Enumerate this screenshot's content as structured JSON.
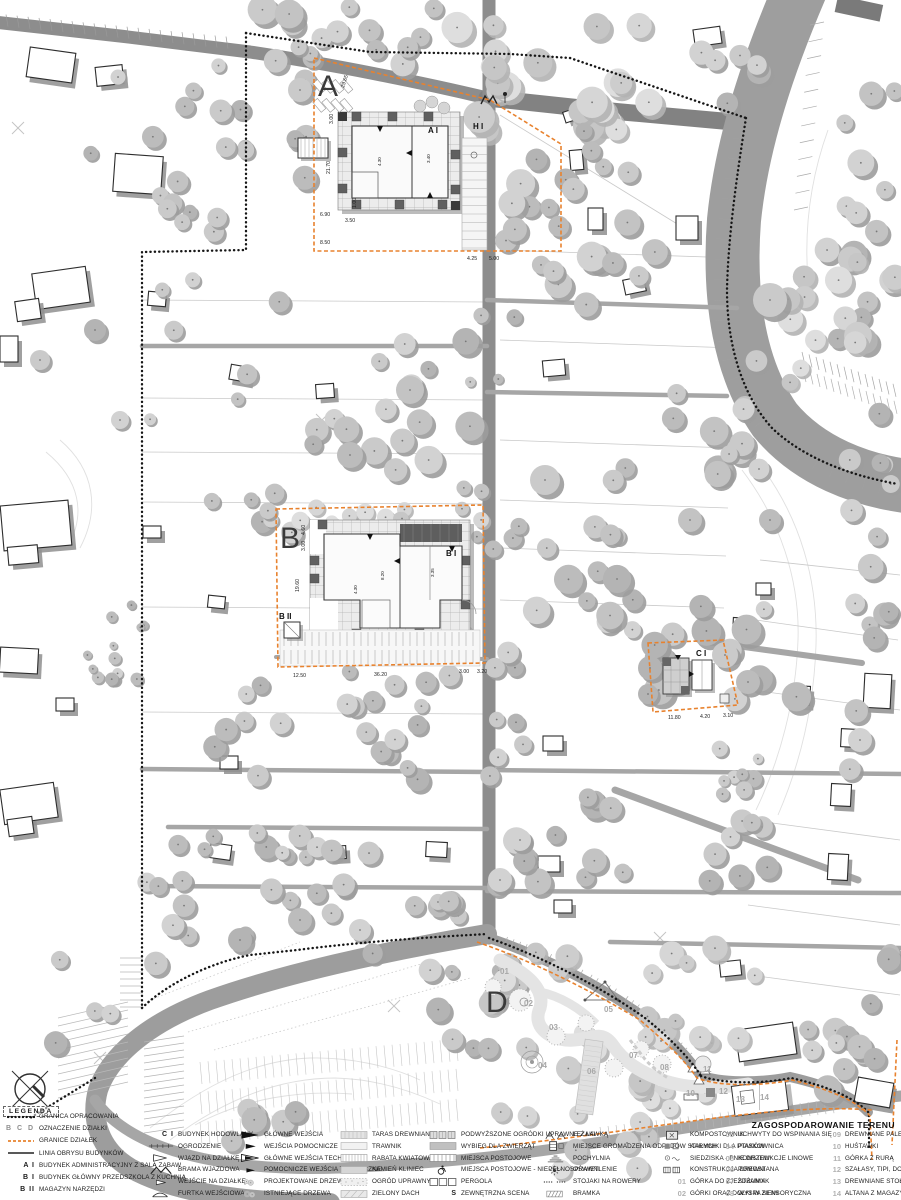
{
  "title": "ZAGOSPODAROWANIE TERENU",
  "legend": {
    "header": "LEGENDA",
    "columns": [
      [
        {
          "icon": "line-dotted",
          "key": "",
          "label": "GRANICA OPRACOWANIA"
        },
        {
          "icon": "letters",
          "key": "A B C D",
          "label": "OZNACZENIE DZIAŁKI"
        },
        {
          "icon": "line-dash-orange",
          "key": "",
          "label": "GRANICE DZIAŁEK"
        },
        {
          "icon": "line-solid",
          "key": "",
          "label": "LINIA OBRYSU BUDYNKÓW"
        },
        {
          "icon": "key",
          "key": "A I",
          "label": "BUDYNEK ADMINISTRACYJNY Z SALĄ ZABAW"
        },
        {
          "icon": "key",
          "key": "B I",
          "label": "BUDYNEK GŁÓWNY PRZEDSZKOLA Z KUCHNIĄ"
        },
        {
          "icon": "key",
          "key": "B II",
          "label": "MAGAZYN NARZĘDZI"
        }
      ],
      [
        {
          "icon": "key",
          "key": "C I",
          "label": "BUDYNEK HODOWLANY"
        },
        {
          "icon": "fence",
          "key": "",
          "label": "OGRODZENIE"
        },
        {
          "icon": "tri-open-lg",
          "key": "",
          "label": "WJAZD NA DZIAŁKĘ"
        },
        {
          "icon": "gate-m",
          "key": "",
          "label": "BRAMA WJAZDOWA"
        },
        {
          "icon": "tri-open-sm",
          "key": "",
          "label": "WEJŚCIE NA DZIAŁKĘ"
        },
        {
          "icon": "gate-f",
          "key": "",
          "label": "FURTKA WEJŚCIOWA"
        }
      ],
      [
        {
          "icon": "arr-lg",
          "key": "",
          "label": "GŁÓWNE WEJŚCIA"
        },
        {
          "icon": "arr-sm",
          "key": "",
          "label": "WEJŚCIA POMOCNICZE"
        },
        {
          "icon": "arr-open",
          "key": "",
          "label": "GŁÓWNE WEJŚCIA TECHNICZNE"
        },
        {
          "icon": "arr-sm2",
          "key": "",
          "label": "POMOCNICZE WEJŚCIA TECHNICZNE"
        },
        {
          "icon": "trees-new",
          "key": "",
          "label": "PROJEKTOWANE DRZEWA"
        },
        {
          "icon": "trees-old",
          "key": "",
          "label": "ISTNIEJĄCE DRZEWA"
        }
      ],
      [
        {
          "icon": "sw-taras",
          "key": "",
          "label": "TARAS DREWNIANY"
        },
        {
          "icon": "sw-trawnik",
          "key": "",
          "label": "TRAWNIK"
        },
        {
          "icon": "sw-rabata",
          "key": "",
          "label": "RABATA KWIATOWA"
        },
        {
          "icon": "sw-kamien",
          "key": "",
          "label": "KAMIEŃ KLINIEC"
        },
        {
          "icon": "sw-ogrod",
          "key": "",
          "label": "OGRÓD UPRAWNY"
        },
        {
          "icon": "sw-dach",
          "key": "",
          "label": "ZIELONY DACH"
        }
      ],
      [
        {
          "icon": "boxes3",
          "key": "",
          "label": "PODWYŻSZONE OGRÓDKI UPRAWNE Z ŁAWKĄ"
        },
        {
          "icon": "sw-wybieg",
          "key": "",
          "label": "WYBIEG DLA ZWIERZĄT"
        },
        {
          "icon": "sw-postoj",
          "key": "",
          "label": "MIEJSCA POSTOJOWE"
        },
        {
          "icon": "disabled",
          "key": "",
          "label": "MIEJSCA POSTOJOWE - NIEPEŁNOSPRAWNI"
        },
        {
          "icon": "pergola",
          "key": "",
          "label": "PERGOLA"
        },
        {
          "icon": "key",
          "key": "S",
          "label": "ZEWNĘTRZNA SCENA"
        }
      ],
      [
        {
          "icon": "lezaki",
          "key": "",
          "label": "LEŻAKI"
        },
        {
          "icon": "odpady",
          "key": "",
          "label": "MIEJSCE GROMADZENIA ODPADÓW STAŁYCH"
        },
        {
          "icon": "ramp",
          "key": "",
          "label": "POCHYLNIA"
        },
        {
          "icon": "light",
          "key": "",
          "label": "OŚWIETLENIE"
        },
        {
          "icon": "bikes",
          "key": "",
          "label": "STOJAKI NA ROWERY"
        },
        {
          "icon": "bramka",
          "key": "",
          "label": "BRAMKA"
        }
      ],
      [
        {
          "icon": "kompost",
          "key": "",
          "label": "KOMPOSTOWNIK"
        },
        {
          "icon": "karmnik",
          "key": "",
          "label": "KARMNIKI DLA PTAKÓW"
        },
        {
          "icon": "siedziska",
          "key": "",
          "label": "SIEDZISKA - PNIE DRZEW"
        },
        {
          "icon": "konstrukcja",
          "key": "",
          "label": "KONSTRUKCJA DREWNIANA"
        },
        {
          "icon": "num",
          "key": "01",
          "label": "GÓRKA DO ZJEŻDŻANIA"
        },
        {
          "icon": "num",
          "key": "02",
          "label": "GÓRKI ORAZ DOŁKI W ZIEMI"
        }
      ],
      [
        {
          "icon": "num",
          "key": "03",
          "label": "UCHWYTY DO WSPINANIA SIĘ"
        },
        {
          "icon": "num",
          "key": "04",
          "label": "PIASKOWNICA"
        },
        {
          "icon": "num",
          "key": "05",
          "label": "KONSTRUKCJE LINOWE"
        },
        {
          "icon": "num",
          "key": "06",
          "label": "POMOST"
        },
        {
          "icon": "num",
          "key": "07",
          "label": "STRUMYK"
        },
        {
          "icon": "num",
          "key": "08",
          "label": "WYSPA SENSORYCZNA"
        }
      ],
      [
        {
          "icon": "num",
          "key": "09",
          "label": "DREWNIANE PALE"
        },
        {
          "icon": "num",
          "key": "10",
          "label": "HUŚTAWKI"
        },
        {
          "icon": "num",
          "key": "11",
          "label": "GÓRKA Z RURĄ"
        },
        {
          "icon": "num",
          "key": "12",
          "label": "SZAŁASY, TIPI, DOMKI"
        },
        {
          "icon": "num",
          "key": "13",
          "label": "DREWNIANE STOŁECZKI"
        },
        {
          "icon": "num",
          "key": "14",
          "label": "ALTANA Z MAGAZYNEM"
        }
      ]
    ]
  },
  "map": {
    "plot_letters": [
      {
        "t": "A",
        "x": 318,
        "y": 96
      },
      {
        "t": "B",
        "x": 280,
        "y": 548
      },
      {
        "t": "D",
        "x": 486,
        "y": 1012
      }
    ],
    "building_labels": [
      {
        "t": "A I",
        "x": 428,
        "y": 133
      },
      {
        "t": "B I",
        "x": 446,
        "y": 556
      },
      {
        "t": "B II",
        "x": 279,
        "y": 619
      },
      {
        "t": "C I",
        "x": 696,
        "y": 656
      },
      {
        "t": "H I",
        "x": 473,
        "y": 129
      }
    ],
    "dimensions": [
      {
        "t": "29.65",
        "x": 344,
        "y": 88,
        "r": -72
      },
      {
        "t": "3.00",
        "x": 333,
        "y": 124,
        "r": -90
      },
      {
        "t": "21.70",
        "x": 330,
        "y": 174,
        "r": -90
      },
      {
        "t": "1.00",
        "x": 356,
        "y": 208,
        "r": -90
      },
      {
        "t": "6.90",
        "x": 320,
        "y": 216
      },
      {
        "t": "3.50",
        "x": 345,
        "y": 222
      },
      {
        "t": "8.50",
        "x": 320,
        "y": 244
      },
      {
        "t": "4.25",
        "x": 467,
        "y": 260
      },
      {
        "t": "5.00",
        "x": 489,
        "y": 260
      },
      {
        "t": "4.30",
        "x": 381,
        "y": 166,
        "r": -90,
        "s": 1
      },
      {
        "t": "3.40",
        "x": 430,
        "y": 163,
        "r": -90,
        "s": 1
      },
      {
        "t": "4.60",
        "x": 305,
        "y": 535,
        "r": -90
      },
      {
        "t": "3.00",
        "x": 305,
        "y": 551,
        "r": -90
      },
      {
        "t": "19.60",
        "x": 299,
        "y": 592,
        "r": -90
      },
      {
        "t": "12.50",
        "x": 293,
        "y": 677
      },
      {
        "t": "36.20",
        "x": 374,
        "y": 676
      },
      {
        "t": "3.00",
        "x": 459,
        "y": 673
      },
      {
        "t": "3.20",
        "x": 477,
        "y": 673
      },
      {
        "t": "4.30",
        "x": 357,
        "y": 594,
        "r": -90,
        "s": 1
      },
      {
        "t": "8.20",
        "x": 384,
        "y": 580,
        "r": -90,
        "s": 1
      },
      {
        "t": "3.35",
        "x": 434,
        "y": 577,
        "r": -90,
        "s": 1
      },
      {
        "t": "11.80",
        "x": 668,
        "y": 719
      },
      {
        "t": "4.20",
        "x": 700,
        "y": 718
      },
      {
        "t": "3.10",
        "x": 723,
        "y": 717
      }
    ],
    "playground_numbers": [
      {
        "t": "01",
        "x": 500,
        "y": 974
      },
      {
        "t": "02",
        "x": 524,
        "y": 1006
      },
      {
        "t": "03",
        "x": 549,
        "y": 1030
      },
      {
        "t": "04",
        "x": 538,
        "y": 1068
      },
      {
        "t": "05",
        "x": 604,
        "y": 1012
      },
      {
        "t": "06",
        "x": 587,
        "y": 1074
      },
      {
        "t": "07",
        "x": 629,
        "y": 1058
      },
      {
        "t": "08",
        "x": 660,
        "y": 1070
      },
      {
        "t": "10",
        "x": 686,
        "y": 1096
      },
      {
        "t": "11",
        "x": 703,
        "y": 1072
      },
      {
        "t": "12",
        "x": 719,
        "y": 1094
      },
      {
        "t": "13",
        "x": 736,
        "y": 1102
      },
      {
        "t": "14",
        "x": 760,
        "y": 1100
      }
    ]
  },
  "colors": {
    "plot_boundary_orange": "#e8822e",
    "road_gray": "#8d8d8d",
    "river_gray": "#9e9e9e",
    "tree_gray": "#bdbdbd"
  }
}
